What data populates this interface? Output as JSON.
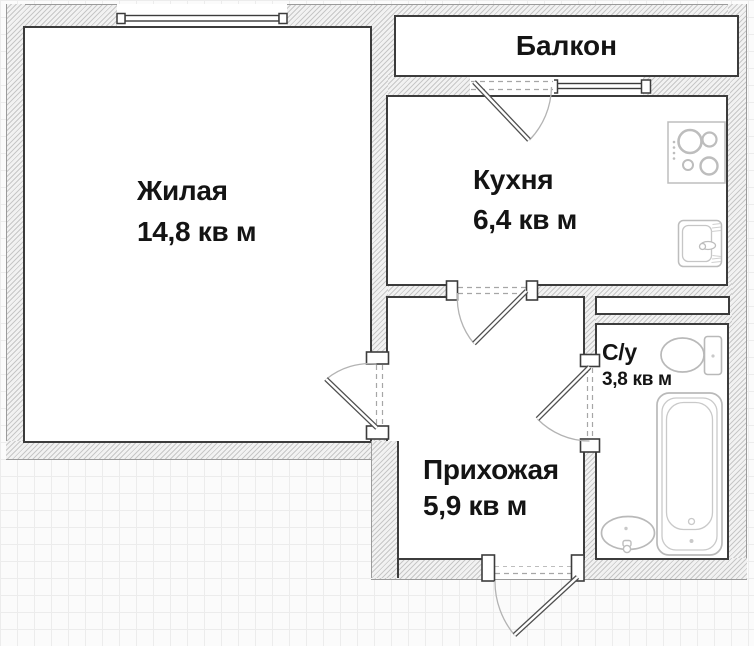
{
  "plan": {
    "title": "apartment-floor-plan",
    "rooms": {
      "living": {
        "name": "Жилая",
        "area": "14,8 кв м"
      },
      "kitchen": {
        "name": "Кухня",
        "area": "6,4 кв м"
      },
      "hallway": {
        "name": "Прихожая",
        "area": "5,9 кв м"
      },
      "bathroom": {
        "name": "С/у",
        "area": "3,8 кв м"
      },
      "balcony": {
        "name": "Балкон"
      }
    },
    "fixtures": [
      "stove-icon",
      "sink-icon",
      "toilet-icon",
      "bathtub-icon",
      "washbasin-icon"
    ],
    "colors": {
      "wall_outline": "#3c3c3c",
      "hatch_line": "#c7c7c7",
      "fixture_line": "#bdbdbd",
      "text": "#141414"
    }
  }
}
